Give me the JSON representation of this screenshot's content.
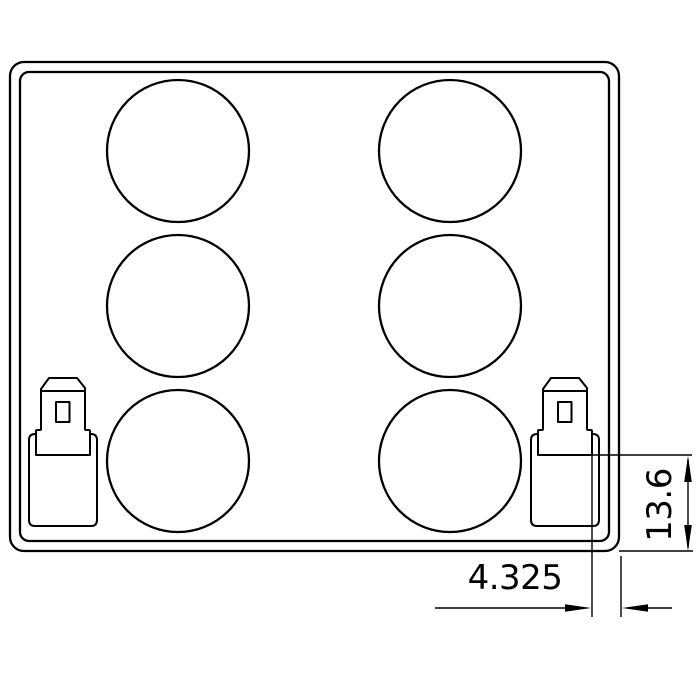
{
  "drawing": {
    "dimensions": {
      "terminal_to_edge": "4.325",
      "seat_to_bottom": "13.6"
    },
    "cells": {
      "count": 6,
      "columns": 2,
      "rows": 3
    },
    "colors": {
      "line": "#000000",
      "background": "#ffffff"
    }
  }
}
